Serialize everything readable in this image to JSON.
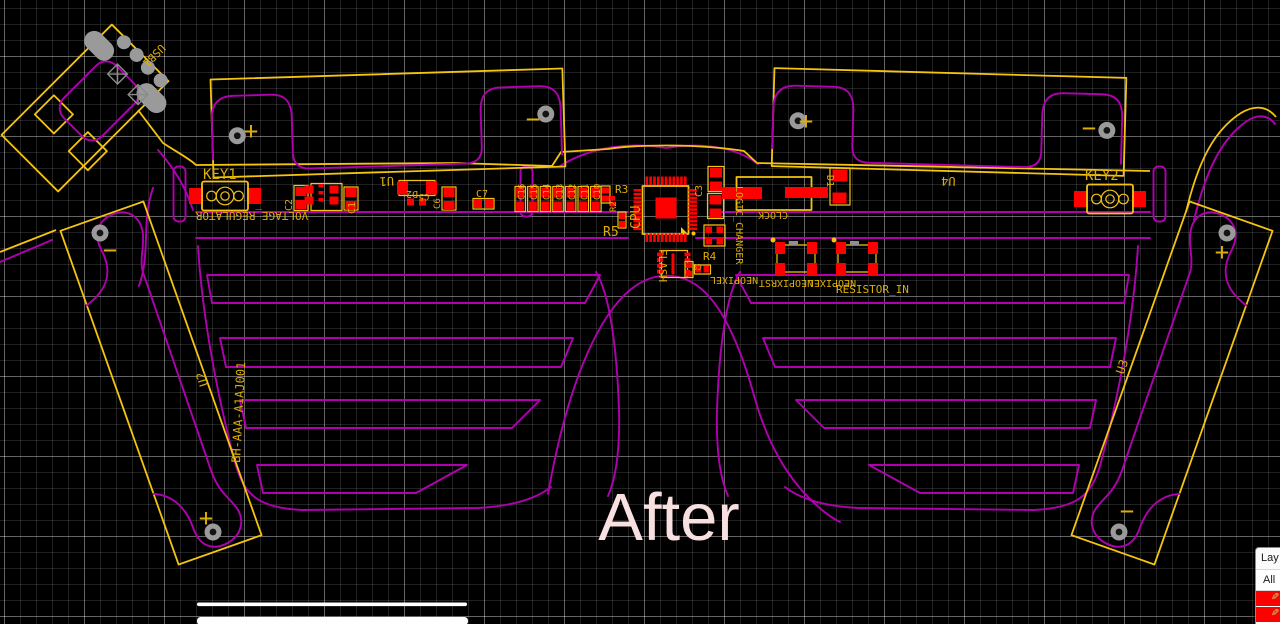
{
  "editor": {
    "caption": "After",
    "layers_panel": {
      "title": "Lay",
      "all_label": "All",
      "layer_rows": 2
    }
  },
  "colors": {
    "board_outline": "#f5c40f",
    "silkscreen": "#ddae04",
    "copper_top": "#ff0000",
    "frame_silk": "#b000b0",
    "pad_drill": "#9a9a9a",
    "caption": "#f9e0e0",
    "layer_swatch": "#ff0000"
  },
  "components": {
    "usb": "USB1",
    "key1": "KEY1",
    "key2": "KEY2",
    "battery_top_left": "U1",
    "battery_top_right": "U4",
    "battery_left": "U2",
    "battery_right": "U3",
    "battery_part_number": "BH-AAA-A1AJ001",
    "voltage_regulator": "VOLTAGE_REGULATOR",
    "cpu": "CPU",
    "flash": "FLASH",
    "clock": "CLOCK",
    "logic_changer": "LOGIC_CHANGER",
    "neopixel_a": "NEOPIXEL",
    "neopixel_rst": "NEOPIXRST",
    "neopixel_b": "NEOPIXEL",
    "resistor_in": "RESISTOR_IN",
    "c1": "C1",
    "c2": "C2",
    "c3": "C3",
    "c5": "C5",
    "c6": "C6",
    "c7": "C7",
    "c9": "C9",
    "cap_bank": [
      "C16",
      "C15",
      "C14",
      "C13",
      "C12",
      "C11",
      "C10"
    ],
    "r2": "R2",
    "r3": "R3",
    "r4": "R4",
    "r5": "R5",
    "d1": "D1",
    "d2": "D2",
    "plus_mark": "+",
    "minus_mark": "−"
  }
}
